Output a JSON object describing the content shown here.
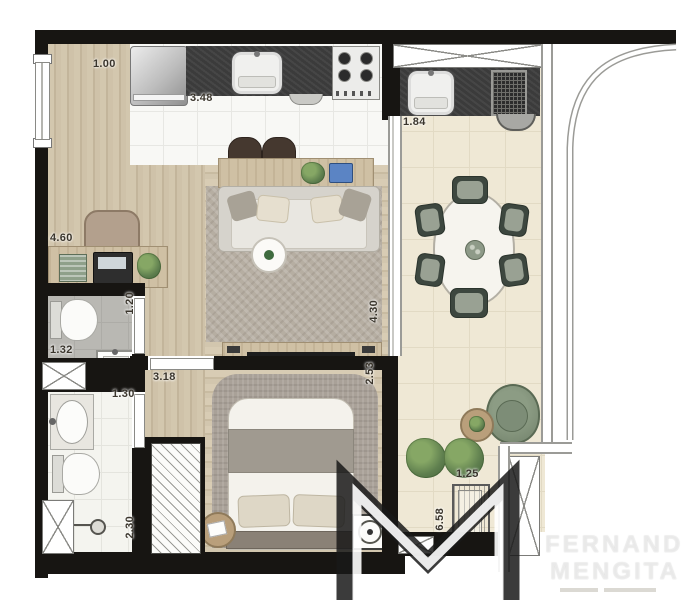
{
  "plan_type": "apartment-floor-plan",
  "watermark": {
    "line1": "FERNANDO",
    "line2": "MENGITA",
    "tagline": ""
  },
  "dims": {
    "office_width": "1.00",
    "kitchen_width": "3.48",
    "office_length": "4.60",
    "balcony_counter": "1.84",
    "bath1_door": "1.20",
    "bath1_width": "1.32",
    "hall_width": "3.18",
    "bath2_door": "1.30",
    "living_length": "4.30",
    "bedroom_width": "2.53",
    "bath2_length": "2.30",
    "ac_width": "1.25",
    "balcony_length": "6.58"
  },
  "colors": {
    "wall": "#171512",
    "wood_floor": "#ccbfa6",
    "kitchen_tile": "#f8f8f5",
    "balcony_tile": "#efe8d5",
    "counter": "#3b3b3b",
    "rug": "#b2aa9e",
    "dining_chair_green": "#3d473f",
    "armchair_green": "#7d8d77",
    "plant_green": "#5e7e4e"
  }
}
